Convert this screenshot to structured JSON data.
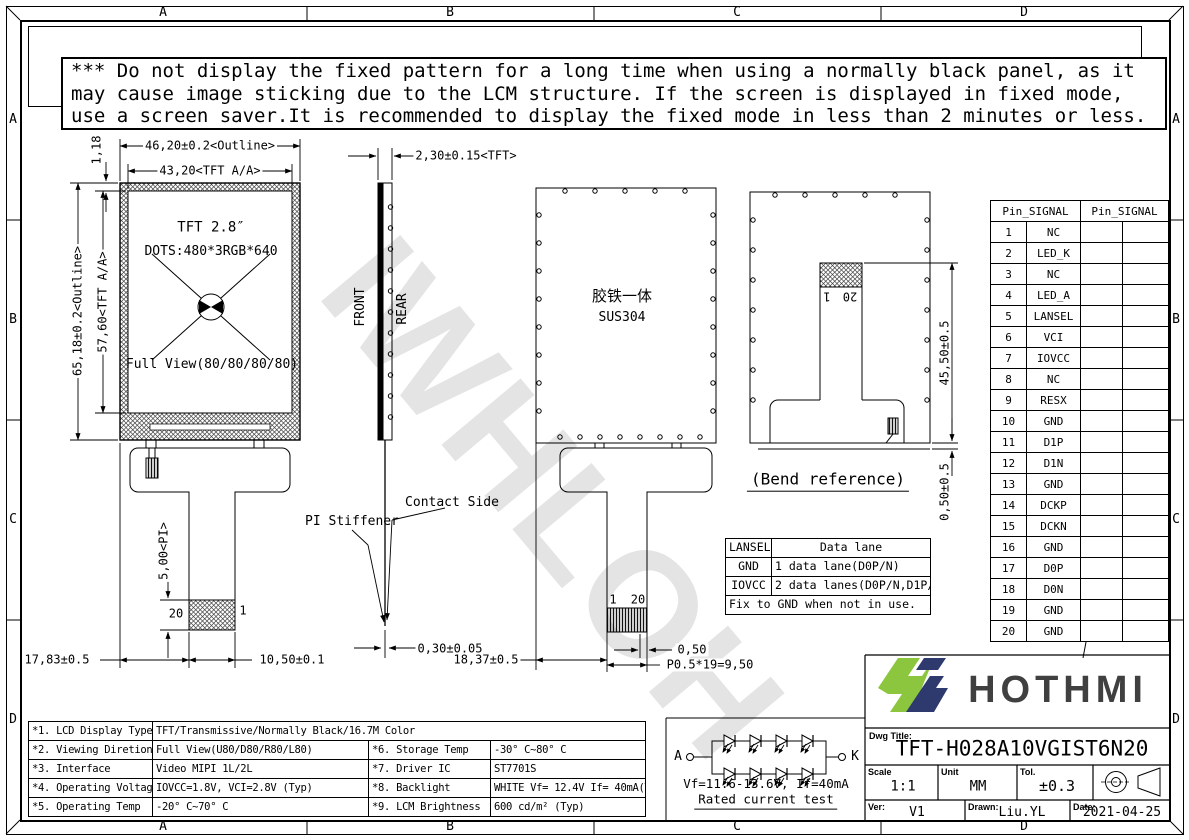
{
  "warning": {
    "lines": [
      "*** Do not display the fixed pattern for a long time when using a normally black panel, as it",
      "may cause image sticking due to the LCM structure. If the screen is displayed in fixed mode,",
      "use a screen saver.It is recommended to display the fixed mode in less than 2 minutes or less."
    ]
  },
  "zones": {
    "top": [
      "A",
      "B",
      "C",
      "D"
    ],
    "bottom": [
      "A",
      "B",
      "C",
      "D"
    ],
    "left": [
      "A",
      "B",
      "C",
      "D"
    ],
    "right": [
      "A",
      "B",
      "C",
      "D"
    ]
  },
  "front_view": {
    "title": "TFT 2.8″",
    "dots": "DOTS:480*3RGB*640",
    "full_view": "Full View(80/80/80/80)",
    "pin_left": "20",
    "pin_right": "1"
  },
  "side_view": {
    "front_label": "FRONT",
    "rear_label": "REAR",
    "contact_side": "Contact Side",
    "pi_stiffener": "PI Stiffener"
  },
  "rear_view": {
    "material_cn": "胶铁一体",
    "material": "SUS304",
    "pin_first": "1",
    "pin_last": "20"
  },
  "bend_view": {
    "caption": "(Bend reference)",
    "pin_first": "1",
    "pin_last": "20"
  },
  "dims": {
    "bezel_top": "1,18",
    "outline_w": "46,20±0.2<Outline>",
    "aa_w": "43,20<TFT A/A>",
    "outline_h": "65,18±0.2<Outline>",
    "aa_h": "57,60<TFT A/A>",
    "tft_thickness": "2,30±0.15<TFT>",
    "pi_len": "5,00<PI>",
    "fpc_offset": "17,83±0.5",
    "fpc_w": "10,50±0.1",
    "fpc_thickness": "0,30±0.05",
    "tail_offset": "18,37±0.5",
    "pitch_end": "0,50",
    "pitch": "P0.5*19=9,50",
    "bend_len": "45,50±0.5",
    "bend_gap": "0,50±0.5"
  },
  "lansel_table": {
    "headers": [
      "LANSEL",
      "Data lane"
    ],
    "rows": [
      [
        "GND",
        "1 data lane(D0P/N)"
      ],
      [
        "IOVCC",
        "2 data lanes(D0P/N,D1P/N)"
      ]
    ],
    "note": "Fix to GND when not in use."
  },
  "pin_table": {
    "headers": [
      "Pin_SIGNAL",
      "Pin_SIGNAL"
    ],
    "rows": [
      {
        "no": "1",
        "signal": "NC"
      },
      {
        "no": "2",
        "signal": "LED_K"
      },
      {
        "no": "3",
        "signal": "NC"
      },
      {
        "no": "4",
        "signal": "LED_A"
      },
      {
        "no": "5",
        "signal": "LANSEL"
      },
      {
        "no": "6",
        "signal": "VCI"
      },
      {
        "no": "7",
        "signal": "IOVCC"
      },
      {
        "no": "8",
        "signal": "NC"
      },
      {
        "no": "9",
        "signal": "RESX"
      },
      {
        "no": "10",
        "signal": "GND"
      },
      {
        "no": "11",
        "signal": "D1P"
      },
      {
        "no": "12",
        "signal": "D1N"
      },
      {
        "no": "13",
        "signal": "GND"
      },
      {
        "no": "14",
        "signal": "DCKP"
      },
      {
        "no": "15",
        "signal": "DCKN"
      },
      {
        "no": "16",
        "signal": "GND"
      },
      {
        "no": "17",
        "signal": "D0P"
      },
      {
        "no": "18",
        "signal": "D0N"
      },
      {
        "no": "19",
        "signal": "GND"
      },
      {
        "no": "20",
        "signal": "GND"
      }
    ]
  },
  "spec_table": {
    "rows": [
      {
        "cells": [
          "*1. LCD Display Type",
          "TFT/Transmissive/Normally Black/16.7M Color"
        ],
        "span": true
      },
      {
        "cells": [
          "*2. Viewing Diretion",
          "Full View(U80/D80/R80/L80)",
          "*6. Storage Temp",
          "-30° C~80° C"
        ]
      },
      {
        "cells": [
          "*3. Interface",
          "Video MIPI 1L/2L",
          "*7. Driver IC",
          "ST7701S"
        ]
      },
      {
        "cells": [
          "*4. Operating Voltage",
          "IOVCC=1.8V, VCI=2.8V (Typ)",
          "*8. Backlight",
          "WHITE Vf= 12.4V If= 40mA(Typ)"
        ]
      },
      {
        "cells": [
          "*5. Operating Temp",
          "-20° C~70° C",
          "*9. LCM Brightness",
          "600 cd/m² (Typ)"
        ]
      }
    ]
  },
  "led_circuit": {
    "anode": "A",
    "cathode": "K",
    "rating": "Vf=11.6-13.6V, If=40mA",
    "caption": "Rated current test"
  },
  "title_block": {
    "brand": "HOTHMI",
    "dwg_title_label": "Dwg Title:",
    "dwg_title": "TFT-H028A10VGIST6N20",
    "scale_label": "Scale",
    "scale": "1:1",
    "unit_label": "Unit",
    "unit": "MM",
    "tol_label": "Tol.",
    "tol": "±0.3",
    "ver_label": "Ver:",
    "ver": "V1",
    "drawn_label": "Drawn:",
    "drawn": "Liu.YL",
    "date_label": "Date:",
    "date": "2021-04-25"
  },
  "watermark": "IWHLOH",
  "colors": {
    "logo_green": "#8CC63E",
    "logo_navy": "#2E3A6E",
    "brand_text": "#404040"
  }
}
